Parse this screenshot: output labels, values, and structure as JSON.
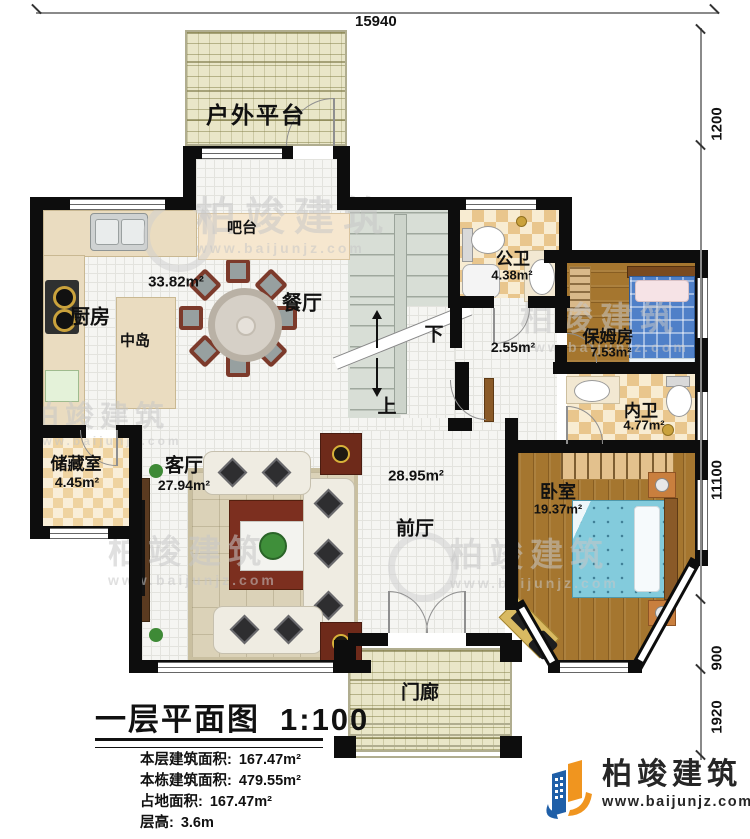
{
  "title": {
    "name": "一层平面图",
    "scale": "1:100"
  },
  "stats": [
    {
      "label": "本层建筑面积:",
      "value": "167.47m²"
    },
    {
      "label": "本栋建筑面积:",
      "value": "479.55m²"
    },
    {
      "label": "占地面积:",
      "value": "167.47m²"
    },
    {
      "label": "层高:",
      "value": "3.6m"
    }
  ],
  "dimensions": {
    "top": "15940",
    "right": [
      "1200",
      "11100",
      "900",
      "1920"
    ]
  },
  "rooms": {
    "outdoor_platform": "户外平台",
    "bar": "吧台",
    "kitchen": "厨房",
    "island": "中岛",
    "dining": "餐厅",
    "kitchen_dining_area": "33.82m²",
    "public_bath": "公卫",
    "public_bath_area": "4.38m²",
    "hall_area": "2.55m²",
    "nanny": "保姆房",
    "nanny_area": "7.53m²",
    "inner_bath": "内卫",
    "inner_bath_area": "4.77m²",
    "storage": "储藏室",
    "storage_area": "4.45m²",
    "living": "客厅",
    "living_area": "27.94m²",
    "foyer": "前厅",
    "foyer_area": "28.95m²",
    "bedroom": "卧室",
    "bedroom_area": "19.37m²",
    "porch": "门廊",
    "stairs_up": "上",
    "stairs_down": "下"
  },
  "watermark": {
    "brand": "柏竣建筑",
    "site": "www.baijunjz.com"
  },
  "logo": {
    "brand": "柏竣建筑",
    "site": "www.baijunjz.com"
  },
  "colors": {
    "wall": "#0d0d0d",
    "accent_blue": "#1f5fa8",
    "accent_orange": "#f0951f"
  }
}
